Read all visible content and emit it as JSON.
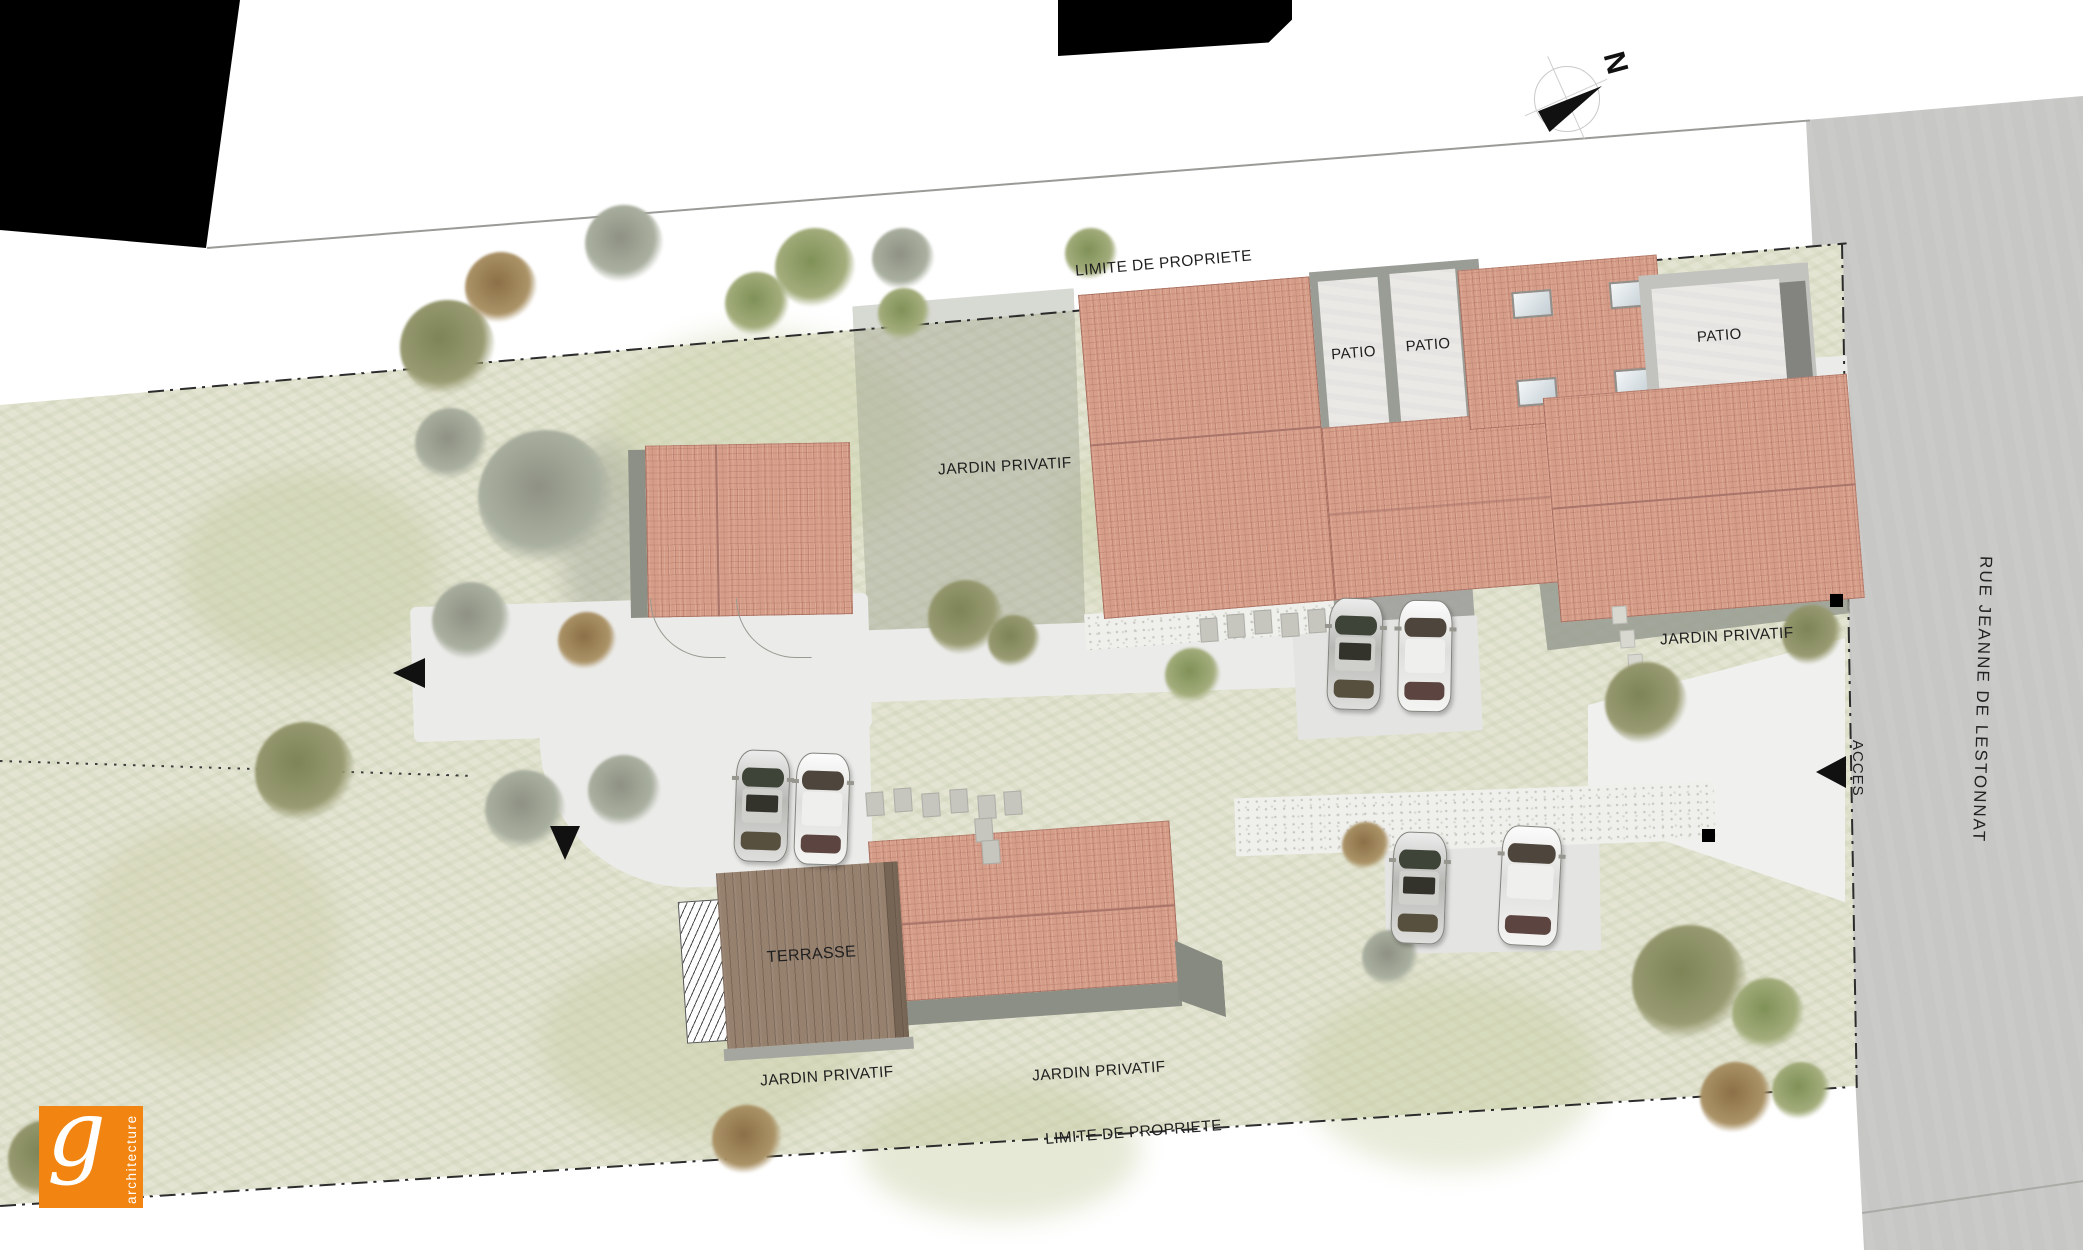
{
  "plan": {
    "labels": {
      "limite_top": "LIMITE DE PROPRIETE",
      "limite_bottom": "LIMITE DE PROPRIETE",
      "jardin_upper": "JARDIN PRIVATIF",
      "jardin_right": "JARDIN PRIVATIF",
      "jardin_bottom_left": "JARDIN PRIVATIF",
      "jardin_bottom_right": "JARDIN PRIVATIF",
      "patio_1": "PATIO",
      "patio_2": "PATIO",
      "patio_3": "PATIO",
      "terrasse": "TERRASSE",
      "acces": "ACCES",
      "street_name": "RUE JEANNE DE LESTONNAT",
      "north": "N"
    },
    "logo": {
      "letter": "g",
      "text": "architecture",
      "color": "#f28511"
    },
    "colors": {
      "roof": "#d69d89",
      "lawn": "#e3e4d1",
      "street": "#c7c7c5",
      "accent_orange": "#f28511"
    }
  }
}
